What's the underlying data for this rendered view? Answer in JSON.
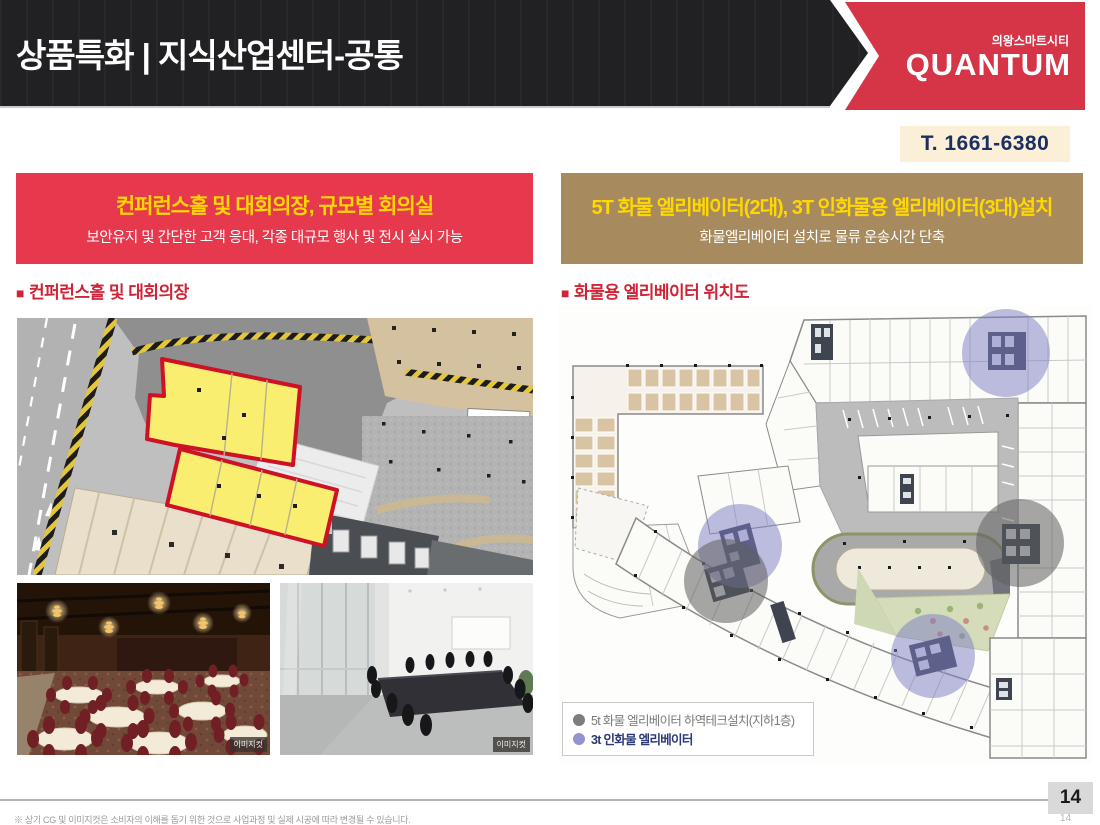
{
  "header": {
    "title": "상품특화 | 지식산업센터-공통",
    "brand_top": "의왕스마트시티",
    "brand_name": "QUANTUM",
    "phone": "T. 1661-6380"
  },
  "left_panel": {
    "banner_title": "컨퍼런스홀 및 대회의장, 규모별 회의실",
    "banner_subtitle": "보안유지 및 간단한 고객 응대, 각종 대규모 행사 및 전시 실시 가능",
    "section_bullet": "■",
    "section_title": "컨퍼런스홀 및 대회의장",
    "photos": [
      {
        "name": "banquet-hall",
        "credit_tag": "이미지컷"
      },
      {
        "name": "meeting-room",
        "credit_tag": "이미지컷"
      }
    ]
  },
  "right_panel": {
    "banner_title": "5T 화물 엘리베이터(2대), 3T 인화물용 엘리베이터(3대)설치",
    "banner_subtitle": "화물엘리베이터 설치로 물류 운송시간 단축",
    "section_bullet": "■",
    "section_title": "화물용 엘리베이터 위치도",
    "legend": [
      {
        "label": "5t 화물 엘리베이터 하역테크설치(지하1층)",
        "color": "#7d7d7d"
      },
      {
        "label": "3t 인화물 엘리베이터",
        "color": "#9393cd"
      }
    ]
  },
  "footer": {
    "disclaimer": "※ 상기 CG 및 이미지컷은 소비자의 이해를 돕기 위한 것으로 사업과정 및 실제 시공에 따라 변경될 수 있습니다.",
    "page_number": "14",
    "page_number_faded": "14"
  },
  "colors": {
    "header_black": "#212123",
    "brand_red": "#d63447",
    "banner_red": "#e7394e",
    "banner_brown": "#a78a5d",
    "accent_yellow": "#ffd800",
    "phone_navy": "#1c2f63",
    "phone_bg": "#fbf0d7",
    "section_red": "#cf2438",
    "highlight_yellow": "#f9ee70",
    "highlight_border_red": "#cf1126",
    "legend_gray": "#7d7d7d",
    "legend_purple": "#9393cd"
  }
}
